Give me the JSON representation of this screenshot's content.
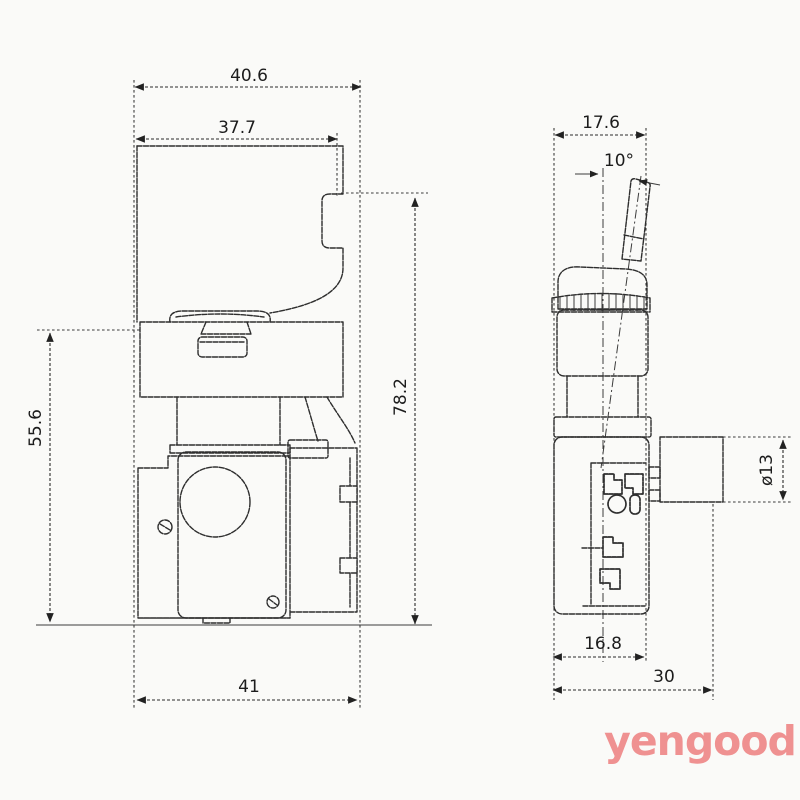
{
  "front_view": {
    "dimensions": {
      "overall_width": "40.6",
      "upper_width": "37.7",
      "lower_height": "55.6",
      "overall_height": "78.2",
      "base_width": "41"
    }
  },
  "side_view": {
    "dimensions": {
      "overall_width": "17.6",
      "lever_angle": "10°",
      "boss_diameter": "ø13",
      "base_width": "16.8",
      "overall_depth": "30"
    }
  },
  "watermark": {
    "text": "yengood",
    "color": "#ef9191"
  }
}
